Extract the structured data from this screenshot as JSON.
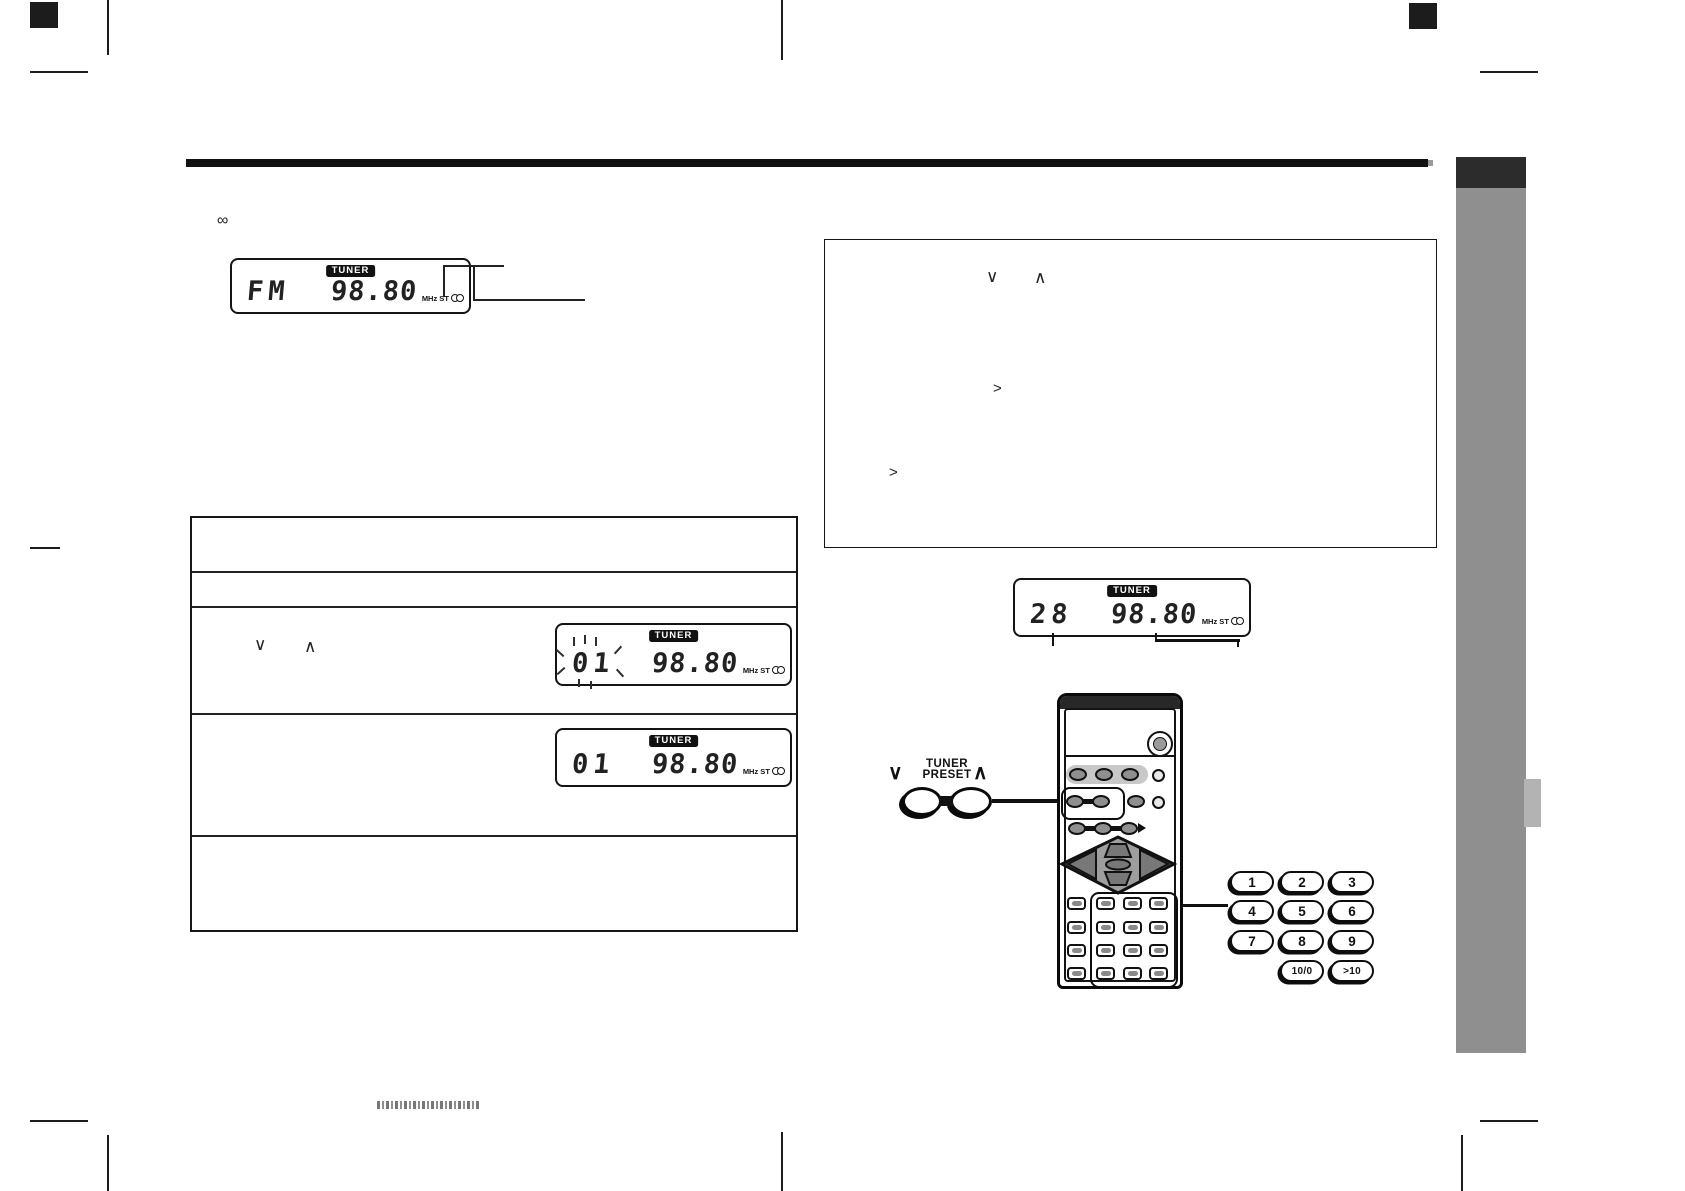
{
  "lcd_displays": {
    "fm": {
      "badge": "TUNER",
      "label": "FM",
      "freq": "98.80",
      "units": "MHz ST"
    },
    "blink": {
      "badge": "TUNER",
      "label": "01",
      "freq": "98.80",
      "units": "MHz ST"
    },
    "stored": {
      "badge": "TUNER",
      "label": "01",
      "freq": "98.80",
      "units": "MHz ST"
    },
    "preset28": {
      "badge": "TUNER",
      "label": "28",
      "freq": "98.80",
      "units": "MHz ST"
    }
  },
  "steps_table": {
    "row3": {
      "down_chevron": "∨",
      "up_chevron": "∧"
    }
  },
  "instruction_panel": {
    "down_chevron": "∨",
    "up_chevron": "∧",
    "more_chevron_1": ">",
    "more_chevron_2": ">"
  },
  "remote_callout": {
    "label_top": "TUNER",
    "label_bottom": "PRESET",
    "down_chevron": "∨",
    "up_chevron": "∧"
  },
  "numpad": {
    "keys": [
      "1",
      "2",
      "3",
      "4",
      "5",
      "6",
      "7",
      "8",
      "9",
      "10/0",
      ">10"
    ]
  },
  "misc": {
    "note_icon": "∞"
  }
}
